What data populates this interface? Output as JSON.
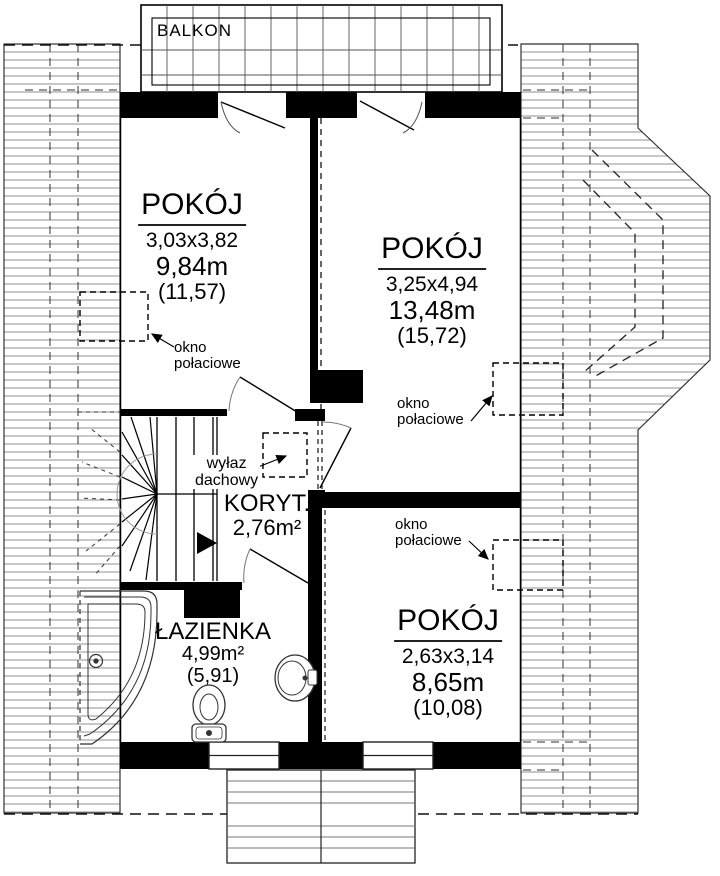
{
  "colors": {
    "wall": "#000000",
    "line": "#333333",
    "hatch_line": "#9a9a9a",
    "background": "#ffffff"
  },
  "balcony": {
    "label": "BALKON"
  },
  "rooms": {
    "left": {
      "name": "POKÓJ",
      "dims": "3,03x3,82",
      "area": "9,84m",
      "total_area": "(11,57)"
    },
    "right": {
      "name": "POKÓJ",
      "dims": "3,25x4,94",
      "area": "13,48m",
      "total_area": "(15,72)"
    },
    "bottom": {
      "name": "POKÓJ",
      "dims": "2,63x3,14",
      "area": "8,65m",
      "total_area": "(10,08)"
    },
    "bathroom": {
      "name": "ŁAZIENKA",
      "area": "4,99m²",
      "total_area": "(5,91)"
    },
    "corridor": {
      "name": "KORYT.",
      "area": "2,76m²"
    }
  },
  "annotations": {
    "roof_window_line1": "okno",
    "roof_window_line2": "połaciowe",
    "roof_hatch_line1": "wyłaz",
    "roof_hatch_line2": "dachowy"
  }
}
